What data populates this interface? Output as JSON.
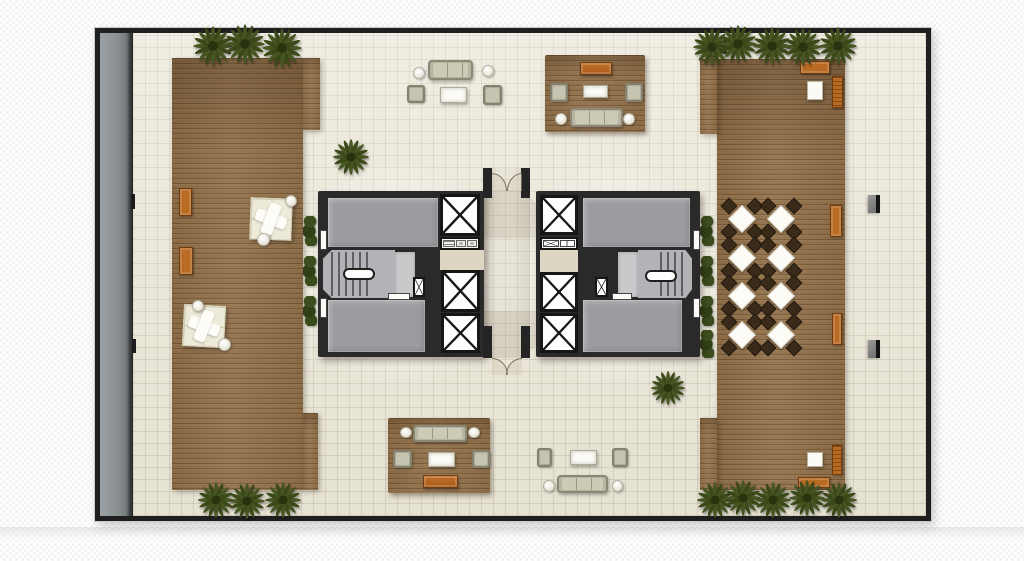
{
  "palette": {
    "background": "#ffffff",
    "wall": "#1f1f1f",
    "tile_floor": "#eae6d7",
    "wood_deck": "#92714a",
    "walkway_gray": "#8a8f92",
    "core_room_gray": "#9c9ca0",
    "stair_gray": "#b3b3b7",
    "elevator_white": "#fdfdfc",
    "foliage_green": "#3b4918",
    "bench_orange": "#b96b24",
    "upholstery": "#b7b4a1",
    "cream_seating": "#edead9",
    "dining_chair_brown": "#392a19"
  },
  "plan": {
    "x": 95,
    "y": 28,
    "w": 836,
    "h": 493,
    "wall_px": 5
  },
  "names": {
    "strip": "perimeter-walkway",
    "floor": "tile-floor",
    "glow": "light-glow",
    "shade": "shadow-overlay",
    "deck": "wood-deck",
    "rug": "area-rug",
    "bush": "shrub",
    "bench": "bench",
    "lounge": "lounge-seating",
    "rtable": "side-table",
    "dset": "dining-set",
    "wtable": "outdoor-table",
    "lounger": "sun-lounger",
    "sofa": "sofa",
    "chair": "armchair",
    "ctable": "coffee-table",
    "console": "console-table",
    "core": "building-core",
    "room": "core-room",
    "lobby": "elevator-lobby",
    "stairs": "stairwell",
    "landing": "stair-landing",
    "rail": "stair-handrail",
    "elev": "elevator-shaft",
    "fix": "core-fixtures",
    "shaft": "service-shaft",
    "doorw": "door-leaf",
    "stub": "wall-stub",
    "arc": "door-swing-arc",
    "palm": "palm-tree",
    "wallobj": "wall-fixture",
    "mark": "wall-mark"
  },
  "items": [
    {
      "t": "strip",
      "r": [
        0,
        0,
        33,
        483
      ]
    },
    {
      "t": "floor",
      "r": [
        33,
        0,
        793,
        483
      ]
    },
    {
      "t": "glow",
      "r": [
        181,
        121,
        240,
        240
      ]
    },
    {
      "t": "glow",
      "r": [
        398,
        121,
        240,
        240
      ]
    },
    {
      "t": "shade",
      "v": "mid",
      "r": [
        383,
        135,
        47,
        190
      ]
    },
    {
      "t": "shade",
      "v": "top",
      "r": [
        345,
        157,
        125,
        48
      ]
    },
    {
      "t": "shade",
      "v": "bot",
      "r": [
        345,
        278,
        125,
        47
      ]
    },
    {
      "t": "deck",
      "r": [
        72,
        25,
        131,
        432
      ]
    },
    {
      "t": "deck",
      "r": [
        203,
        25,
        17,
        72
      ]
    },
    {
      "t": "deck",
      "r": [
        203,
        380,
        15,
        77
      ]
    },
    {
      "t": "deck",
      "r": [
        617,
        26,
        128,
        431
      ]
    },
    {
      "t": "deck",
      "r": [
        600,
        26,
        17,
        75
      ]
    },
    {
      "t": "deck",
      "r": [
        600,
        385,
        17,
        72
      ]
    },
    {
      "t": "rug",
      "r": [
        445,
        22,
        100,
        77
      ]
    },
    {
      "t": "rug",
      "r": [
        288,
        385,
        102,
        75
      ]
    },
    {
      "t": "bush",
      "r": [
        203,
        183,
        14,
        30
      ]
    },
    {
      "t": "bush",
      "r": [
        203,
        223,
        14,
        30
      ]
    },
    {
      "t": "bush",
      "r": [
        203,
        263,
        14,
        30
      ]
    },
    {
      "t": "bush",
      "r": [
        600,
        183,
        14,
        30
      ]
    },
    {
      "t": "bush",
      "r": [
        600,
        223,
        14,
        30
      ]
    },
    {
      "t": "bush",
      "r": [
        600,
        263,
        14,
        30
      ]
    },
    {
      "t": "bush",
      "r": [
        600,
        297,
        14,
        28
      ]
    },
    {
      "t": "bench",
      "r": [
        79,
        155,
        13,
        28
      ]
    },
    {
      "t": "bench",
      "r": [
        79,
        214,
        14,
        28
      ]
    },
    {
      "t": "lounge",
      "r": [
        150,
        165,
        42,
        42
      ],
      "rot": 2
    },
    {
      "t": "rtable",
      "r": [
        185,
        162,
        12,
        12
      ]
    },
    {
      "t": "rtable",
      "r": [
        157,
        200,
        13,
        13
      ]
    },
    {
      "t": "lounge",
      "r": [
        83,
        272,
        42,
        42
      ],
      "rot": 3
    },
    {
      "t": "rtable",
      "r": [
        92,
        267,
        12,
        12
      ]
    },
    {
      "t": "rtable",
      "r": [
        118,
        305,
        13,
        13
      ]
    },
    {
      "t": "dset",
      "r": [
        624,
        168,
        36,
        36
      ]
    },
    {
      "t": "dset",
      "r": [
        663,
        168,
        36,
        36
      ]
    },
    {
      "t": "dset",
      "r": [
        624,
        207,
        36,
        36
      ]
    },
    {
      "t": "dset",
      "r": [
        663,
        207,
        36,
        36
      ]
    },
    {
      "t": "dset",
      "r": [
        624,
        245,
        36,
        36
      ]
    },
    {
      "t": "dset",
      "r": [
        663,
        245,
        36,
        36
      ]
    },
    {
      "t": "dset",
      "r": [
        624,
        284,
        36,
        36
      ]
    },
    {
      "t": "dset",
      "r": [
        663,
        284,
        36,
        36
      ]
    },
    {
      "t": "bench",
      "r": [
        730,
        172,
        12,
        32
      ]
    },
    {
      "t": "bench",
      "r": [
        732,
        280,
        10,
        32
      ]
    },
    {
      "t": "bench",
      "r": [
        700,
        28,
        30,
        13
      ]
    },
    {
      "t": "wtable",
      "r": [
        707,
        48,
        16,
        19
      ]
    },
    {
      "t": "lounger",
      "r": [
        732,
        43,
        11,
        32
      ]
    },
    {
      "t": "lounger",
      "r": [
        732,
        412,
        10,
        30
      ]
    },
    {
      "t": "wtable",
      "r": [
        707,
        419,
        16,
        15
      ]
    },
    {
      "t": "bench",
      "r": [
        698,
        444,
        32,
        11
      ]
    },
    {
      "t": "sofa",
      "r": [
        328,
        27,
        45,
        20
      ]
    },
    {
      "t": "rtable",
      "r": [
        313,
        34,
        12,
        12
      ]
    },
    {
      "t": "rtable",
      "r": [
        382,
        32,
        12,
        12
      ]
    },
    {
      "t": "chair",
      "r": [
        307,
        52,
        18,
        18
      ]
    },
    {
      "t": "chair",
      "r": [
        383,
        52,
        19,
        20
      ]
    },
    {
      "t": "ctable",
      "r": [
        340,
        54,
        27,
        16
      ]
    },
    {
      "t": "console",
      "r": [
        480,
        29,
        32,
        13
      ]
    },
    {
      "t": "chair",
      "r": [
        450,
        50,
        18,
        19
      ]
    },
    {
      "t": "chair",
      "r": [
        525,
        50,
        18,
        19
      ]
    },
    {
      "t": "ctable",
      "r": [
        483,
        52,
        25,
        13
      ]
    },
    {
      "t": "sofa",
      "r": [
        470,
        75,
        53,
        19
      ]
    },
    {
      "t": "rtable",
      "r": [
        455,
        80,
        12,
        12
      ]
    },
    {
      "t": "rtable",
      "r": [
        523,
        80,
        12,
        12
      ]
    },
    {
      "t": "sofa",
      "r": [
        313,
        392,
        54,
        17
      ]
    },
    {
      "t": "rtable",
      "r": [
        300,
        394,
        12,
        11
      ]
    },
    {
      "t": "rtable",
      "r": [
        368,
        394,
        12,
        11
      ]
    },
    {
      "t": "chair",
      "r": [
        293,
        417,
        19,
        18
      ]
    },
    {
      "t": "chair",
      "r": [
        372,
        417,
        18,
        18
      ]
    },
    {
      "t": "ctable",
      "r": [
        328,
        419,
        27,
        15
      ]
    },
    {
      "t": "console",
      "r": [
        323,
        442,
        35,
        13
      ]
    },
    {
      "t": "chair",
      "r": [
        437,
        415,
        15,
        19
      ]
    },
    {
      "t": "chair",
      "r": [
        512,
        415,
        16,
        19
      ]
    },
    {
      "t": "ctable",
      "r": [
        470,
        417,
        27,
        15
      ]
    },
    {
      "t": "sofa",
      "r": [
        457,
        442,
        51,
        18
      ]
    },
    {
      "t": "rtable",
      "r": [
        443,
        447,
        12,
        12
      ]
    },
    {
      "t": "rtable",
      "r": [
        512,
        447,
        11,
        12
      ]
    },
    {
      "t": "core",
      "r": [
        218,
        158,
        166,
        166
      ]
    },
    {
      "t": "core",
      "r": [
        436,
        158,
        164,
        166
      ]
    },
    {
      "t": "room",
      "r": [
        228,
        165,
        110,
        49
      ]
    },
    {
      "t": "room",
      "r": [
        228,
        267,
        97,
        52
      ]
    },
    {
      "t": "room",
      "r": [
        483,
        165,
        107,
        49
      ]
    },
    {
      "t": "room",
      "r": [
        483,
        267,
        99,
        52
      ]
    },
    {
      "t": "lobby",
      "r": [
        340,
        217,
        44,
        20
      ]
    },
    {
      "t": "lobby",
      "r": [
        440,
        217,
        38,
        22
      ]
    },
    {
      "t": "stairs",
      "v": "L",
      "r": [
        223,
        217,
        72,
        48
      ]
    },
    {
      "t": "landing",
      "r": [
        295,
        219,
        20,
        45
      ]
    },
    {
      "t": "rail",
      "r": [
        243,
        235,
        32,
        12
      ]
    },
    {
      "t": "stairs",
      "v": "R",
      "r": [
        538,
        217,
        54,
        48
      ]
    },
    {
      "t": "landing",
      "r": [
        518,
        219,
        20,
        45
      ]
    },
    {
      "t": "rail",
      "r": [
        545,
        237,
        32,
        12
      ]
    },
    {
      "t": "elev",
      "r": [
        340,
        161,
        40,
        42
      ]
    },
    {
      "t": "elev",
      "r": [
        341,
        237,
        39,
        42
      ]
    },
    {
      "t": "elev",
      "r": [
        341,
        280,
        39,
        40
      ]
    },
    {
      "t": "elev",
      "r": [
        440,
        162,
        38,
        40
      ]
    },
    {
      "t": "elev",
      "r": [
        440,
        239,
        38,
        40
      ]
    },
    {
      "t": "elev",
      "r": [
        440,
        280,
        38,
        40
      ]
    },
    {
      "t": "fix",
      "v": "sinks",
      "r": [
        340,
        204,
        40,
        13
      ]
    },
    {
      "t": "fix",
      "v": "shafts",
      "r": [
        440,
        204,
        38,
        13
      ]
    },
    {
      "t": "shaft",
      "r": [
        313,
        244,
        12,
        20
      ]
    },
    {
      "t": "shaft",
      "r": [
        495,
        244,
        13,
        20
      ]
    },
    {
      "t": "doorw",
      "r": [
        220,
        197,
        7,
        20
      ]
    },
    {
      "t": "doorw",
      "r": [
        220,
        265,
        7,
        20
      ]
    },
    {
      "t": "doorw",
      "r": [
        288,
        260,
        22,
        7
      ]
    },
    {
      "t": "doorw",
      "r": [
        593,
        197,
        7,
        20
      ]
    },
    {
      "t": "doorw",
      "r": [
        593,
        265,
        7,
        20
      ]
    },
    {
      "t": "doorw",
      "r": [
        512,
        260,
        20,
        7
      ]
    },
    {
      "t": "stub",
      "r": [
        383,
        135,
        9,
        30
      ]
    },
    {
      "t": "stub",
      "r": [
        421,
        135,
        9,
        30
      ]
    },
    {
      "t": "stub",
      "r": [
        383,
        293,
        9,
        32
      ]
    },
    {
      "t": "stub",
      "r": [
        421,
        293,
        9,
        32
      ]
    },
    {
      "t": "arc",
      "v": "atr",
      "r": [
        392,
        140,
        15,
        18
      ]
    },
    {
      "t": "arc",
      "v": "atl",
      "r": [
        407,
        140,
        15,
        18
      ]
    },
    {
      "t": "arc",
      "v": "atr",
      "r": [
        392,
        325,
        16,
        17
      ]
    },
    {
      "t": "arc",
      "v": "atl",
      "r": [
        406,
        325,
        16,
        17
      ]
    },
    {
      "t": "palm",
      "r": [
        91,
        -9,
        44,
        44
      ]
    },
    {
      "t": "palm",
      "r": [
        123,
        -11,
        44,
        44
      ]
    },
    {
      "t": "palm",
      "r": [
        160,
        -7,
        44,
        44
      ]
    },
    {
      "t": "palm",
      "r": [
        231,
        104,
        40,
        40
      ]
    },
    {
      "t": "palm",
      "r": [
        591,
        -7,
        42,
        42
      ]
    },
    {
      "t": "palm",
      "r": [
        617,
        -10,
        42,
        42
      ]
    },
    {
      "t": "palm",
      "r": [
        651,
        -8,
        42,
        42
      ]
    },
    {
      "t": "palm",
      "r": [
        682,
        -7,
        42,
        42
      ]
    },
    {
      "t": "palm",
      "r": [
        717,
        -8,
        42,
        42
      ]
    },
    {
      "t": "palm",
      "r": [
        96,
        447,
        40,
        40
      ]
    },
    {
      "t": "palm",
      "r": [
        127,
        448,
        40,
        40
      ]
    },
    {
      "t": "palm",
      "r": [
        163,
        447,
        40,
        40
      ]
    },
    {
      "t": "palm",
      "r": [
        595,
        447,
        40,
        40
      ]
    },
    {
      "t": "palm",
      "r": [
        623,
        445,
        40,
        40
      ]
    },
    {
      "t": "palm",
      "r": [
        653,
        447,
        40,
        40
      ]
    },
    {
      "t": "palm",
      "r": [
        687,
        445,
        40,
        40
      ]
    },
    {
      "t": "palm",
      "r": [
        719,
        447,
        40,
        40
      ]
    },
    {
      "t": "palm",
      "r": [
        549,
        336,
        38,
        38
      ]
    },
    {
      "t": "wallobj",
      "r": [
        768,
        162,
        12,
        18
      ]
    },
    {
      "t": "wallobj",
      "r": [
        768,
        307,
        12,
        18
      ]
    },
    {
      "t": "mark",
      "r": [
        31,
        161,
        4,
        15
      ]
    },
    {
      "t": "mark",
      "r": [
        32,
        306,
        4,
        14
      ]
    }
  ]
}
